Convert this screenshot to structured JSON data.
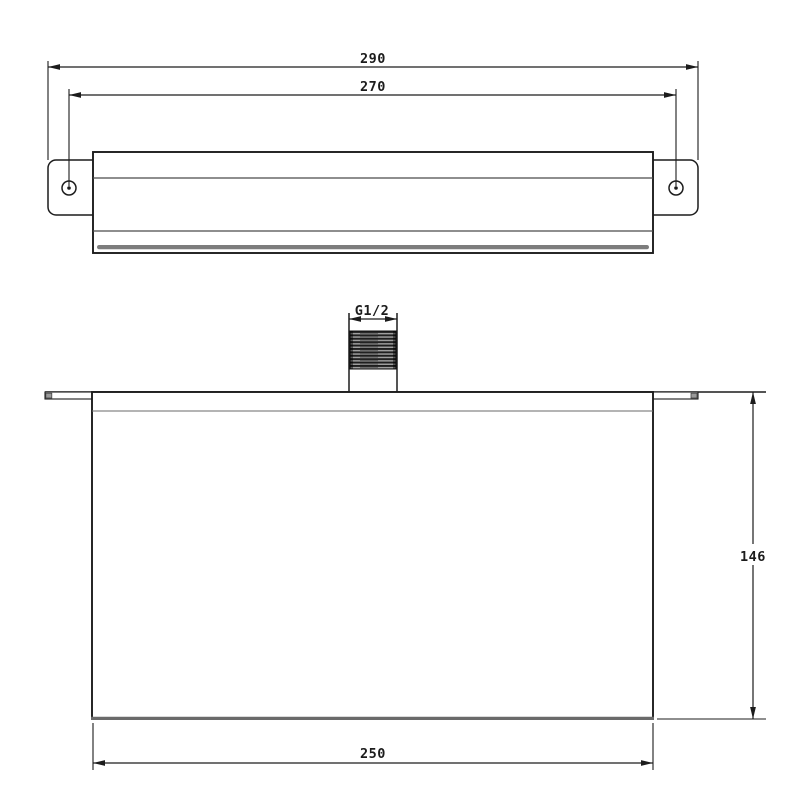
{
  "drawing": {
    "dimensions": {
      "overall_width": "290",
      "hole_spacing": "270",
      "thread": "G1/2",
      "height": "146",
      "body_width": "250"
    },
    "colors": {
      "background": "#ffffff",
      "line": "#1c1c1c",
      "inner_line": "#4a4a4a",
      "gray_line": "#6a6a6a",
      "slot": "#7d7d7d",
      "thread_dark": "#1e1e1e",
      "thread_light": "#9e9e9e",
      "tab_cap": "#9a9a9a"
    }
  }
}
